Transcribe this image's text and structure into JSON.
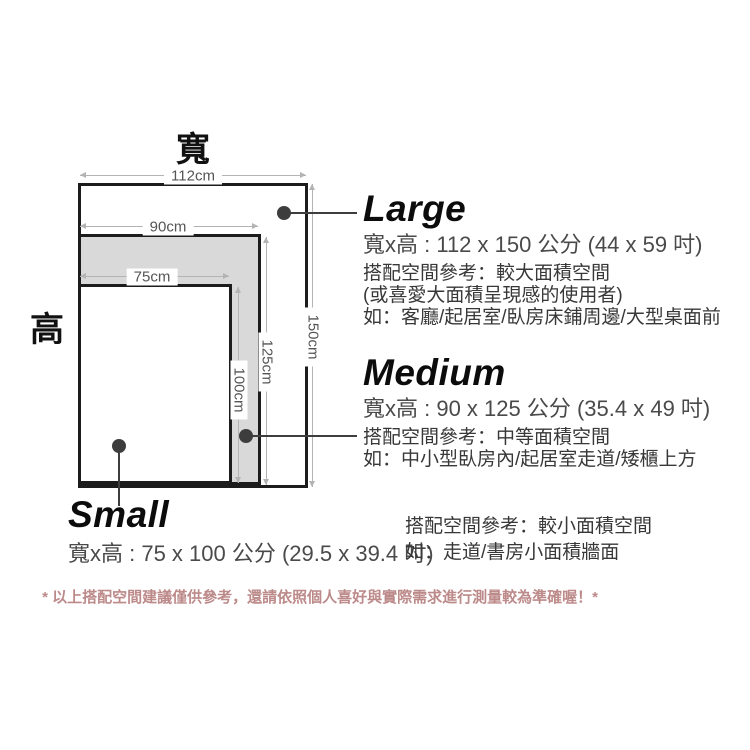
{
  "diagram": {
    "width_axis_label": "寬",
    "height_axis_label": "高",
    "dimensions": {
      "large_width": "112cm",
      "medium_width": "90cm",
      "small_width": "75cm",
      "large_height": "150cm",
      "medium_height": "125cm",
      "small_height": "100cm"
    }
  },
  "sizes": [
    {
      "name": "Large",
      "size_text": "寬x高 : 112 x 150 公分 (44 x 59 吋)",
      "desc": [
        "搭配空間參考：較大面積空間",
        "(或喜愛大面積呈現感的使用者)",
        "如：客廳/起居室/臥房床鋪周邊/大型桌面前"
      ]
    },
    {
      "name": "Medium",
      "size_text": "寬x高 : 90 x 125 公分 (35.4 x 49 吋)",
      "desc": [
        "搭配空間參考：中等面積空間",
        "如：中小型臥房內/起居室走道/矮櫃上方"
      ]
    },
    {
      "name": "Small",
      "size_text": "寬x高 : 75 x 100 公分 (29.5 x 39.4 吋)",
      "desc": [
        "搭配空間參考：較小面積空間",
        "如：走道/書房小面積牆面"
      ]
    }
  ],
  "footer": {
    "note": "* 以上搭配空間建議僅供參考，還請依照個人喜好與實際需求進行測量較為準確喔！*"
  },
  "colors": {
    "outline": "#1c1c1c",
    "medium_fill": "#d9d9d9",
    "dim_line": "#b3b3b3",
    "dim_text": "#555555",
    "pointer": "#3d3d3d",
    "note_text": "#bd8a8a"
  }
}
